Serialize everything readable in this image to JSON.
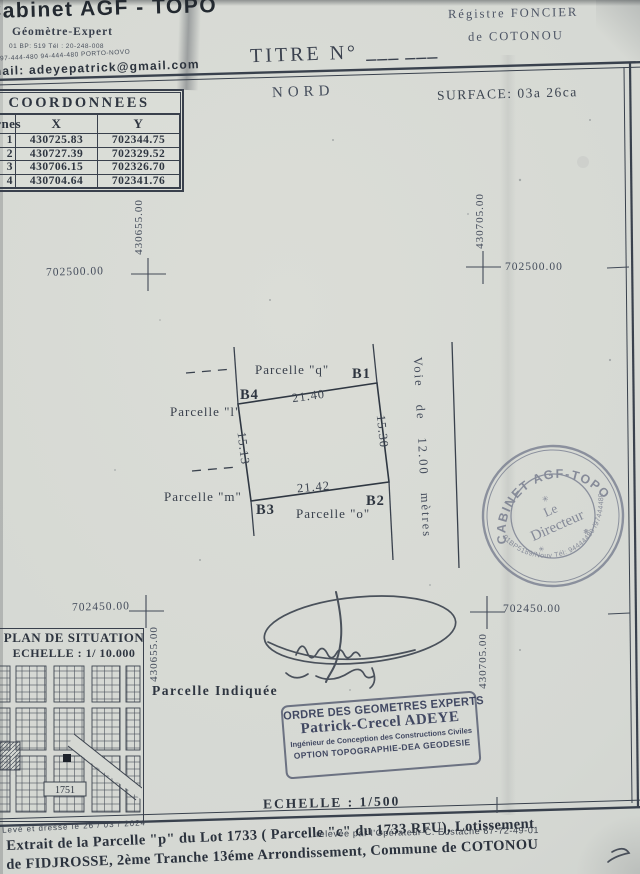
{
  "letterhead": {
    "cabinet": "Cabinet AGF - TOPO",
    "profession": "Géomètre-Expert",
    "tel1": "01 BP: 519 Tél : 20-248-008",
    "tel2": "97-444-480 94-444-480 PORTO-NOVO",
    "email": "E-mail: adeyepatrick@gmail.com"
  },
  "registre": {
    "line1": "Régistre FONCIER",
    "line2": "de COTONOU"
  },
  "titre": {
    "label": "TITRE  N°",
    "blank": "___ ___"
  },
  "header": {
    "nord": "NORD",
    "surface": "SURFACE: 03a 26ca"
  },
  "coord_table": {
    "title": "COORDONNEES",
    "col_borne": "Bornes",
    "col_x": "X",
    "col_y": "Y",
    "rows": [
      {
        "borne": "1",
        "x": "430725.83",
        "y": "702344.75"
      },
      {
        "borne": "2",
        "x": "430727.39",
        "y": "702329.52"
      },
      {
        "borne": "3",
        "x": "430706.15",
        "y": "702326.70"
      },
      {
        "borne": "4",
        "x": "430704.64",
        "y": "702341.76"
      }
    ]
  },
  "grid_marks": {
    "tl": {
      "x_label": "702500.00",
      "y_label": "430655.00"
    },
    "tr": {
      "x_label": "702500.00",
      "y_label": "430705.00"
    },
    "bl": {
      "x_label": "702450.00",
      "y_label": "430655.00"
    },
    "br": {
      "x_label": "702450.00",
      "y_label": "430705.00"
    }
  },
  "parcel": {
    "b1": "B1",
    "b2": "B2",
    "b3": "B3",
    "b4": "B4",
    "edge_top": "21.40",
    "edge_right": "15.30",
    "edge_bottom": "21.42",
    "edge_left": "15.13",
    "neighbor_q": "Parcelle \"q\"",
    "neighbor_l": "Parcelle \"l\"",
    "neighbor_m": "Parcelle \"m\"",
    "neighbor_o": "Parcelle \"o\"",
    "road": "Voie de 12.00 mètres"
  },
  "situation": {
    "title": "PLAN DE SITUATION",
    "scale": "ECHELLE : 1/ 10.000",
    "lot_label": "1751",
    "indicated": "Parcelle  Indiquée"
  },
  "stamps": {
    "round": {
      "arc_top": "✳ CABINET AGF-TOPO ✳",
      "center1": "Le",
      "center2": "Directeur",
      "arc_bottom": "01BP5189/Nouv Tél: 94444480 /97444480"
    },
    "rect": {
      "line1": "ORDRE DES GEOMETRES EXPERTS",
      "line2": "Patrick-Crecel ADEYE",
      "line3": "Ingénieur de Conception des Constructions Civiles",
      "line4": "OPTION TOPOGRAPHIE-DEA GEODESIE"
    }
  },
  "scale_bar": {
    "label": "ECHELLE : 1/500"
  },
  "footer": {
    "leve": "Levé et dressé le 26 / 03 / 2024",
    "releve": "relevée par l'Opérateur C. Eustache 67-72-49-01",
    "extrait1": "Extrait  de la Parcelle \"p\" du Lot 1733 ( Parcelle \"c\" du 1733 RFU), Lotissement",
    "extrait2": "de FIDJROSSE, 2ème Tranche 13éme Arrondissement, Commune de COTONOU"
  },
  "colors": {
    "ink": "#333a45",
    "paper": "#d5d8d3",
    "stamp": "#6e7488"
  }
}
